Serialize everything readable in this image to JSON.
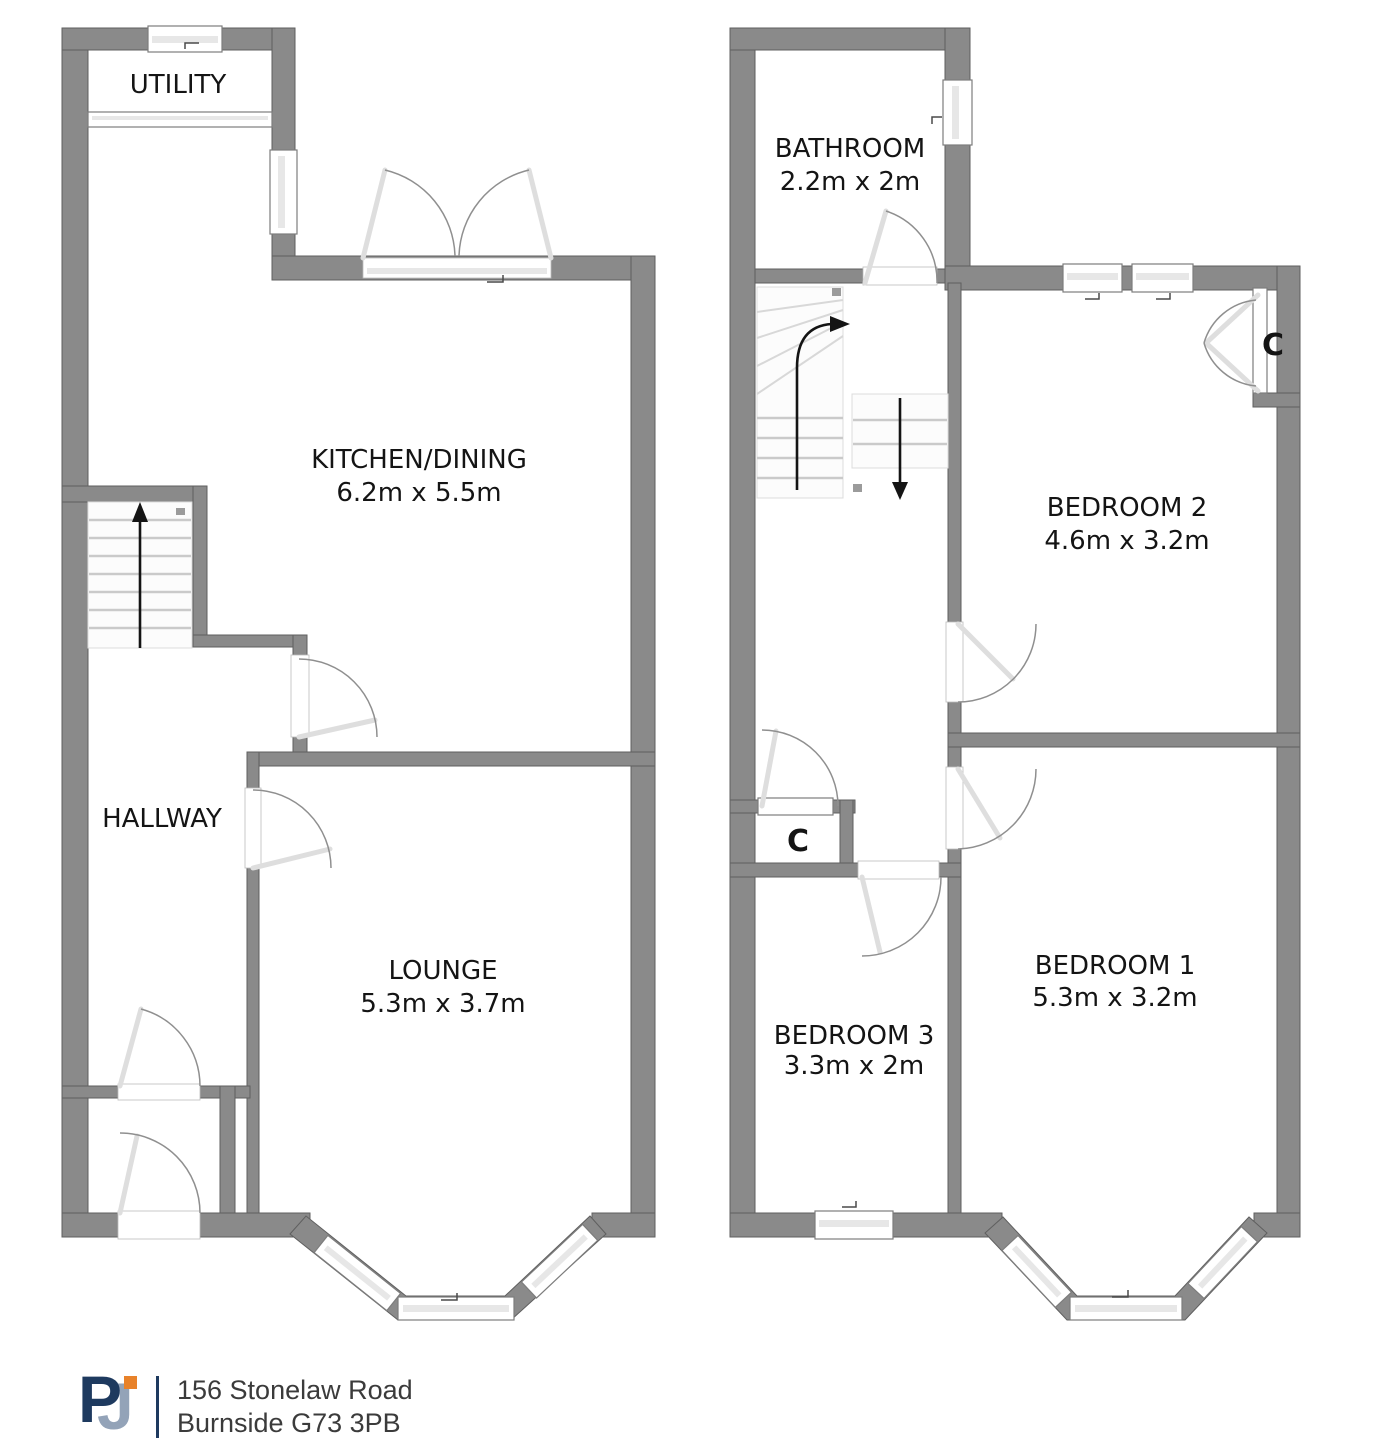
{
  "floors": {
    "ground": {
      "rooms": {
        "utility": {
          "name": "UTILITY"
        },
        "kitchen_dining": {
          "name": "KITCHEN/DINING",
          "dims": "6.2m x 5.5m"
        },
        "hallway": {
          "name": "HALLWAY"
        },
        "lounge": {
          "name": "LOUNGE",
          "dims": "5.3m x 3.7m"
        }
      }
    },
    "first": {
      "rooms": {
        "bathroom": {
          "name": "BATHROOM",
          "dims": "2.2m x 2m"
        },
        "bedroom2": {
          "name": "BEDROOM 2",
          "dims": "4.6m x 3.2m"
        },
        "bedroom1": {
          "name": "BEDROOM 1",
          "dims": "5.3m x 3.2m"
        },
        "bedroom3": {
          "name": "BEDROOM 3",
          "dims": "3.3m x 2m"
        },
        "closet_bedroom2": {
          "label": "C"
        },
        "closet_landing": {
          "label": "C"
        }
      }
    }
  },
  "footer": {
    "logo": {
      "letter_p": "P",
      "letter_j": "J"
    },
    "address_line1": "156 Stonelaw Road",
    "address_line2": "Burnside G73 3PB"
  },
  "colors": {
    "wall": "#8a8a8a",
    "wall_edge": "#5f5f5f",
    "label_text": "#141414",
    "logo_navy": "#1e3a5f",
    "logo_steel": "#93a3b8",
    "logo_orange": "#e8822a",
    "address_text": "#3b3b3b"
  }
}
